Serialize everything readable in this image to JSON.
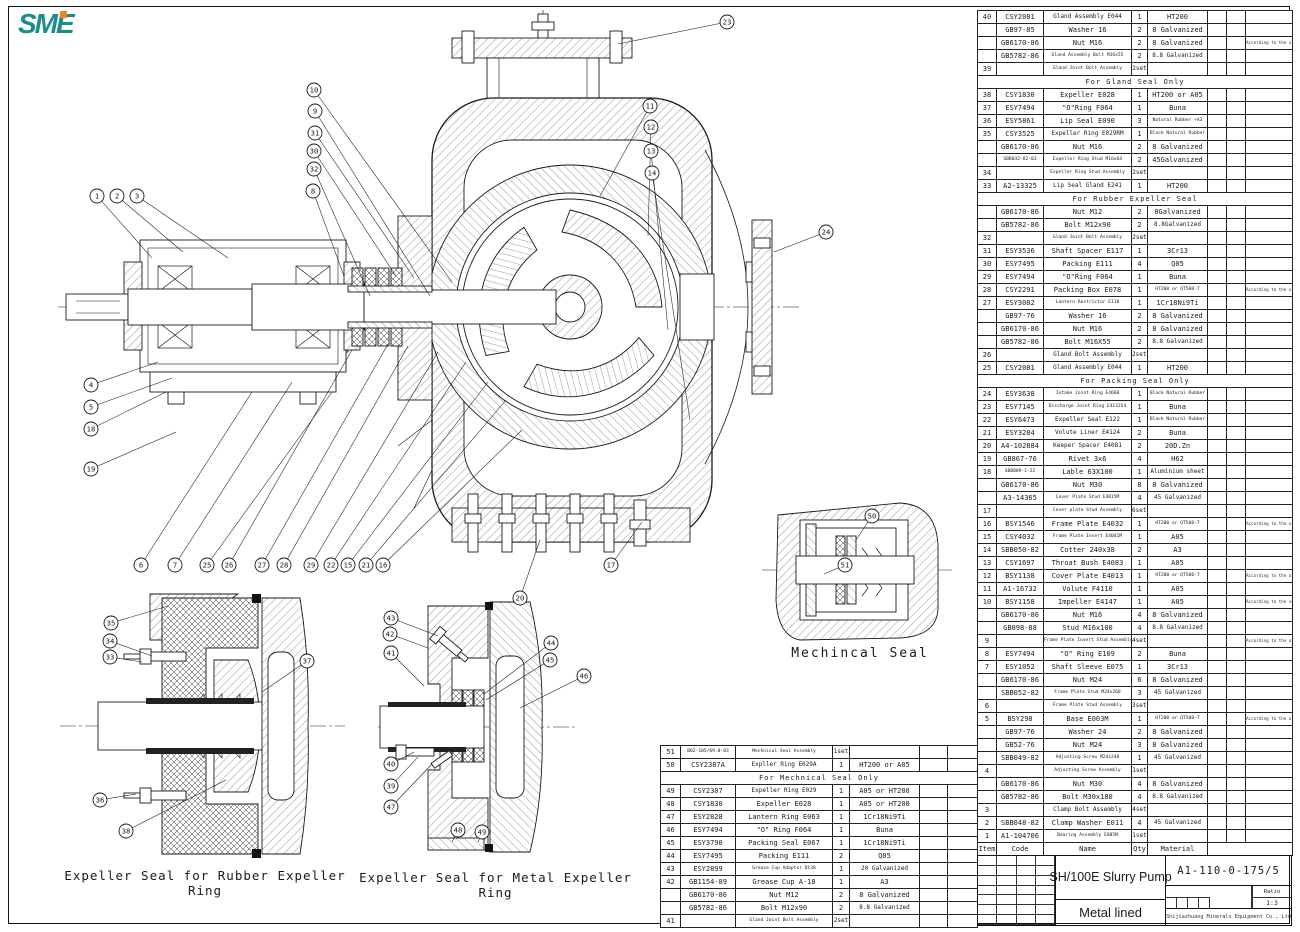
{
  "logo": {
    "text": "SME",
    "teal": "#1b8d8d",
    "orange": "#f0861e"
  },
  "labels": {
    "mechanical_seal": "Mechincal Seal",
    "rubber_detail": "Expeller Seal for Rubber Expeller Ring",
    "metal_detail": "Expeller Seal for Metal Expeller Ring"
  },
  "title_block": {
    "drawing_number": "A1-110-0-175/5",
    "title": "SH/100E Slurry Pump",
    "lining": "Metal lined",
    "ratio_label": "Ratio",
    "ratio_value": "1:3",
    "company": "Shijiazhuang Minerals Equipment Co., Ltd"
  },
  "parts_table": {
    "headers": {
      "item": "Item",
      "code": "Code",
      "name": "Name",
      "qty": "Qty",
      "material": "Material"
    },
    "rows": [
      {
        "item": "40",
        "code": "CSY2081",
        "name": "Gland Assembly E044",
        "qty": "1",
        "mat": "HT200"
      },
      {
        "code": "GB97-85",
        "name": "Washer 16",
        "qty": "2",
        "mat": "8 Galvanized"
      },
      {
        "code": "GB6170-86",
        "name": "Nut  M16",
        "qty": "2",
        "mat": "8 Galvanized",
        "remark": "According to the order"
      },
      {
        "code": "GB5782-86",
        "name": "Gland Assembly Bolt M16x55",
        "qty": "2",
        "mat": "8.8 Galvanized"
      },
      {
        "item": "39",
        "name": "Gland Joint Bolt Assembly",
        "qty": "2set"
      },
      {
        "section": "For Gland Seal Only"
      },
      {
        "item": "38",
        "code": "CSY1830",
        "name": "Expeller  E028",
        "qty": "1",
        "mat": "HT200 or A05"
      },
      {
        "item": "37",
        "code": "ESY7494",
        "name": "\"O\"Ring F064",
        "qty": "1",
        "mat": "Buna"
      },
      {
        "item": "36",
        "code": "ESY5861",
        "name": "Lip Seal E090",
        "qty": "3",
        "mat": "Natural Rubber +A3"
      },
      {
        "item": "35",
        "code": "CSY3525",
        "name": "Expeller Ring E029RM",
        "qty": "1",
        "mat": "Black Natural Rubber"
      },
      {
        "code": "GB6170-86",
        "name": "Nut  M16",
        "qty": "2",
        "mat": "8 Galvanized"
      },
      {
        "code": "SBB032-82-03",
        "name": "Expeller Ring Stud M16x64",
        "qty": "2",
        "mat": "45Galvanized"
      },
      {
        "item": "34",
        "name": "Expeller Ring Stud Assembly",
        "qty": "2set"
      },
      {
        "item": "33",
        "code": "A2-13325",
        "name": "Lip Seal Gland E241",
        "qty": "1",
        "mat": "HT200"
      },
      {
        "section": "For Rubber Expeller Seal"
      },
      {
        "code": "GB6170-86",
        "name": "Nut  M12",
        "qty": "2",
        "mat": "8Galvanized"
      },
      {
        "code": "GB5782-86",
        "name": "Bolt  M12x90",
        "qty": "2",
        "mat": "8.8Galvanized"
      },
      {
        "item": "32",
        "name": "Gland Joint Bolt Assembly",
        "qty": "2set"
      },
      {
        "item": "31",
        "code": "ESY3536",
        "name": "Shaft Spacer E117",
        "qty": "1",
        "mat": "3Cr13"
      },
      {
        "item": "30",
        "code": "ESY7495",
        "name": "Packing E111",
        "qty": "4",
        "mat": "Q05"
      },
      {
        "item": "29",
        "code": "ESY7494",
        "name": "\"O\"Ring F064",
        "qty": "1",
        "mat": "Buna"
      },
      {
        "item": "28",
        "code": "CSY2291",
        "name": "Packing Box E078",
        "qty": "1",
        "mat": "HT200 or QT500-7",
        "remark": "According to the order"
      },
      {
        "item": "27",
        "code": "ESY3082",
        "name": "Lantern Restrictor E118",
        "qty": "1",
        "mat": "1Cr18Ni9Ti"
      },
      {
        "code": "GB97-76",
        "name": "Washer 16",
        "qty": "2",
        "mat": "8 Galvanized"
      },
      {
        "code": "GB6170-86",
        "name": "Nut M16",
        "qty": "2",
        "mat": "8 Galvanized"
      },
      {
        "code": "GB5782-86",
        "name": "Bolt M16X55",
        "qty": "2",
        "mat": "8.8 Galvanized"
      },
      {
        "item": "26",
        "name": "Gland Bolt Assembly",
        "qty": "2sets"
      },
      {
        "item": "25",
        "code": "CSY2081",
        "name": "Gland Assembly E044",
        "qty": "1",
        "mat": "HT200"
      },
      {
        "section": "For Packing Seal Only"
      },
      {
        "item": "24",
        "code": "ESY3638",
        "name": "Intake Joint Ring E4660",
        "qty": "1",
        "mat": "Black Natural Rubber"
      },
      {
        "item": "23",
        "code": "ESY7145",
        "name": "Discharge Joint Ring E4132S4",
        "qty": "1",
        "mat": "Buna"
      },
      {
        "item": "22",
        "code": "ESY6473",
        "name": "Expeller Seal E122",
        "qty": "1",
        "mat": "Black Natural Rubber"
      },
      {
        "item": "21",
        "code": "ESY3284",
        "name": "Volute Liner E4124",
        "qty": "2",
        "mat": "Buna"
      },
      {
        "item": "20",
        "code": "A4-102884",
        "name": "Keeper Spacer E4081",
        "qty": "2",
        "mat": "20D.Zn"
      },
      {
        "item": "19",
        "code": "GB867-76",
        "name": "Rivet 3x6",
        "qty": "4",
        "mat": "H62"
      },
      {
        "item": "18",
        "code": "SBB009-1-22",
        "name": "Lable 63X100",
        "qty": "1",
        "mat": "Aluminium sheet"
      },
      {
        "code": "GB6170-86",
        "name": "Nut  M30",
        "qty": "8",
        "mat": "8 Galvanized"
      },
      {
        "code": "A3-14365",
        "name": "Cover Plate Stud E4015M",
        "qty": "4",
        "mat": "45 Galvanized"
      },
      {
        "item": "17",
        "name": "Cover plate Stud Assembly",
        "qty": "6sets"
      },
      {
        "item": "16",
        "code": "BSY1546",
        "name": "Frame Plate E4032",
        "qty": "1",
        "mat": "HT200 or QT500-7",
        "remark": "According to the order"
      },
      {
        "item": "15",
        "code": "CSY4032",
        "name": "Frame Plate Insert E4041M",
        "qty": "1",
        "mat": "A05"
      },
      {
        "item": "14",
        "code": "SBB050-82",
        "name": "Cotter 240x38",
        "qty": "2",
        "mat": "A3"
      },
      {
        "item": "13",
        "code": "CSY1697",
        "name": "Throat Bush E4083",
        "qty": "1",
        "mat": "A05"
      },
      {
        "item": "12",
        "code": "BSY1138",
        "name": "Cover Plate E4013",
        "qty": "1",
        "mat": "HT200 or QT500-7",
        "remark": "According to the order"
      },
      {
        "item": "11",
        "code": "A1-16732",
        "name": "Volute F4110",
        "qty": "1",
        "mat": "A05"
      },
      {
        "item": "10",
        "code": "BSY1158",
        "name": "Impeller E4147",
        "qty": "1",
        "mat": "A05",
        "remark": "According to the seal type"
      },
      {
        "code": "GB6170-86",
        "name": "Nut M16",
        "qty": "4",
        "mat": "8 Galvanized"
      },
      {
        "code": "GB898-88",
        "name": "Stud M16x100",
        "qty": "4",
        "mat": "8.8 Galvanized"
      },
      {
        "item": "9",
        "name": "Frame Plate Insert Stud Assembly",
        "qty": "4sets",
        "remark": "According to the order"
      },
      {
        "item": "8",
        "code": "ESY7494",
        "name": "\"O\" Ring E109",
        "qty": "2",
        "mat": "Buna"
      },
      {
        "item": "7",
        "code": "ESY1052",
        "name": "Shaft Sleeve E075",
        "qty": "1",
        "mat": "3Cr13"
      },
      {
        "code": "GB6170-86",
        "name": "Nut M24",
        "qty": "6",
        "mat": "8 Galvanized"
      },
      {
        "code": "SBB052-82",
        "name": "Frame Plate Stud M24x260",
        "qty": "3",
        "mat": "45 Galvanized"
      },
      {
        "item": "6",
        "name": "Frame Plate Stud Assembly",
        "qty": "3sets"
      },
      {
        "item": "5",
        "code": "BSY298",
        "name": "Base E003M",
        "qty": "1",
        "mat": "HT200 or QT500-7",
        "remark": "According to the order"
      },
      {
        "code": "GB97-76",
        "name": "Washer 24",
        "qty": "2",
        "mat": "8 Galvanized"
      },
      {
        "code": "GB52-76",
        "name": "Nut M24",
        "qty": "3",
        "mat": "8 Galvanized"
      },
      {
        "code": "SBB049-82",
        "name": "Adjusting Screw M24x240",
        "qty": "1",
        "mat": "45 Galvanized"
      },
      {
        "item": "4",
        "name": "Adjusting Screw Assembly",
        "qty": "1set"
      },
      {
        "code": "GB6170-86",
        "name": "Nut M30",
        "qty": "4",
        "mat": "8 Galvanized"
      },
      {
        "code": "GB5782-86",
        "name": "Bolt  M30x180",
        "qty": "4",
        "mat": "8.8 Galvanized"
      },
      {
        "item": "3",
        "name": "Clamp Bolt Assembly",
        "qty": "4set"
      },
      {
        "item": "2",
        "code": "SBB048-82",
        "name": "Clamp Washer E011",
        "qty": "4",
        "mat": "45 Galvanized"
      },
      {
        "item": "1",
        "code": "A1-104706",
        "name": "Bearing Assembly E085M",
        "qty": "1set"
      },
      {
        "header": true
      }
    ]
  },
  "seal_table": {
    "rows": [
      {
        "item": "51",
        "code": "B02-105/69.0-03",
        "name": "Mechnical Seal Assembly",
        "qty": "1set"
      },
      {
        "item": "50",
        "code": "CSY2387A",
        "name": "Expller Ring E029A",
        "qty": "1",
        "mat": "HT200 or A05"
      },
      {
        "section": "For Mechnical Seal Only"
      },
      {
        "item": "49",
        "code": "CSY2307",
        "name": "Expeller Ring E029",
        "qty": "1",
        "mat": "A05 or HT200"
      },
      {
        "item": "48",
        "code": "CSY1830",
        "name": "Expeller E028",
        "qty": "1",
        "mat": "A05 or HT200"
      },
      {
        "item": "47",
        "code": "ESY2828",
        "name": "Lantern Ring E063",
        "qty": "1",
        "mat": "1Cr18Ni9Ti"
      },
      {
        "item": "46",
        "code": "ESY7494",
        "name": "\"O\" Ring F064",
        "qty": "1",
        "mat": "Buna"
      },
      {
        "item": "45",
        "code": "ESY3790",
        "name": "Packing Seal E067",
        "qty": "1",
        "mat": "1Cr18Ni9Ti"
      },
      {
        "item": "44",
        "code": "ESY7495",
        "name": "Packing E111",
        "qty": "2",
        "mat": "Q05"
      },
      {
        "item": "43",
        "code": "ESY2899",
        "name": "Grease Cup Adaptor Dt38",
        "qty": "1",
        "mat": "20 Galvanized"
      },
      {
        "item": "42",
        "code": "GB1154-89",
        "name": "Grease Cup A-18",
        "qty": "1",
        "mat": "A3"
      },
      {
        "code": "GB6170-86",
        "name": "Nut M12",
        "qty": "2",
        "mat": "8 Galvanized"
      },
      {
        "code": "GB5782-86",
        "name": "Bolt  M12x90",
        "qty": "2",
        "mat": "8.8 Galvanized"
      },
      {
        "item": "41",
        "name": "Gland Joint Bolt Assembly",
        "qty": "2set"
      }
    ]
  },
  "callouts": {
    "main": [
      {
        "n": "1",
        "x": 97,
        "y": 196,
        "tx": 152,
        "ty": 258
      },
      {
        "n": "2",
        "x": 117,
        "y": 196,
        "tx": 183,
        "ty": 252
      },
      {
        "n": "3",
        "x": 137,
        "y": 196,
        "tx": 228,
        "ty": 258
      },
      {
        "n": "10",
        "x": 314,
        "y": 90,
        "tx": 452,
        "ty": 282
      },
      {
        "n": "9",
        "x": 315,
        "y": 111,
        "tx": 430,
        "ty": 296
      },
      {
        "n": "31",
        "x": 315,
        "y": 133,
        "tx": 414,
        "ty": 278
      },
      {
        "n": "30",
        "x": 314,
        "y": 151,
        "tx": 396,
        "ty": 276
      },
      {
        "n": "32",
        "x": 314,
        "y": 169,
        "tx": 370,
        "ty": 296
      },
      {
        "n": "8",
        "x": 313,
        "y": 191,
        "tx": 344,
        "ty": 276
      },
      {
        "n": "23",
        "x": 727,
        "y": 22,
        "tx": 618,
        "ty": 44
      },
      {
        "n": "11",
        "x": 650,
        "y": 106,
        "tx": 600,
        "ty": 196
      },
      {
        "n": "12",
        "x": 651,
        "y": 127,
        "tx": 648,
        "ty": 236
      },
      {
        "n": "13",
        "x": 651,
        "y": 151,
        "tx": 668,
        "ty": 330
      },
      {
        "n": "14",
        "x": 652,
        "y": 173,
        "tx": 690,
        "ty": 420
      },
      {
        "n": "24",
        "x": 826,
        "y": 232,
        "tx": 774,
        "ty": 252
      },
      {
        "n": "4",
        "x": 91,
        "y": 385,
        "tx": 158,
        "ty": 362
      },
      {
        "n": "5",
        "x": 91,
        "y": 407,
        "tx": 172,
        "ty": 378
      },
      {
        "n": "18",
        "x": 91,
        "y": 429,
        "tx": 166,
        "ty": 392
      },
      {
        "n": "19",
        "x": 91,
        "y": 469,
        "tx": 176,
        "ty": 432
      },
      {
        "n": "6",
        "x": 141,
        "y": 565,
        "tx": 252,
        "ty": 392
      },
      {
        "n": "7",
        "x": 175,
        "y": 565,
        "tx": 292,
        "ty": 382
      },
      {
        "n": "25",
        "x": 207,
        "y": 565,
        "tx": 332,
        "ty": 392
      },
      {
        "n": "26",
        "x": 229,
        "y": 565,
        "tx": 352,
        "ty": 350
      },
      {
        "n": "27",
        "x": 262,
        "y": 565,
        "tx": 388,
        "ty": 344
      },
      {
        "n": "28",
        "x": 284,
        "y": 565,
        "tx": 408,
        "ty": 346
      },
      {
        "n": "29",
        "x": 311,
        "y": 565,
        "tx": 438,
        "ty": 352
      },
      {
        "n": "22",
        "x": 331,
        "y": 565,
        "tx": 466,
        "ty": 362
      },
      {
        "n": "15",
        "x": 348,
        "y": 565,
        "tx": 488,
        "ty": 382
      },
      {
        "n": "21",
        "x": 366,
        "y": 565,
        "tx": 506,
        "ty": 400
      },
      {
        "n": "16",
        "x": 383,
        "y": 565,
        "tx": 522,
        "ty": 430
      },
      {
        "n": "20",
        "x": 520,
        "y": 598,
        "tx": 540,
        "ty": 540
      },
      {
        "n": "17",
        "x": 611,
        "y": 565,
        "tx": 642,
        "ty": 522
      }
    ],
    "mech_seal": [
      {
        "n": "50",
        "x": 872,
        "y": 516,
        "tx": 856,
        "ty": 540
      },
      {
        "n": "51",
        "x": 845,
        "y": 565,
        "tx": 824,
        "ty": 574
      }
    ],
    "rubber_detail": [
      {
        "n": "35",
        "x": 111,
        "y": 623,
        "tx": 168,
        "ty": 606
      },
      {
        "n": "34",
        "x": 110,
        "y": 641,
        "tx": 152,
        "ty": 656
      },
      {
        "n": "33",
        "x": 110,
        "y": 657,
        "tx": 142,
        "ty": 662
      },
      {
        "n": "37",
        "x": 307,
        "y": 661,
        "tx": 262,
        "ty": 692
      },
      {
        "n": "36",
        "x": 100,
        "y": 800,
        "tx": 136,
        "ty": 794
      },
      {
        "n": "38",
        "x": 126,
        "y": 831,
        "tx": 226,
        "ty": 780
      }
    ],
    "metal_detail": [
      {
        "n": "43",
        "x": 391,
        "y": 618,
        "tx": 438,
        "ty": 636
      },
      {
        "n": "42",
        "x": 390,
        "y": 634,
        "tx": 428,
        "ty": 648
      },
      {
        "n": "41",
        "x": 391,
        "y": 653,
        "tx": 424,
        "ty": 686
      },
      {
        "n": "44",
        "x": 551,
        "y": 643,
        "tx": 484,
        "ty": 694
      },
      {
        "n": "45",
        "x": 550,
        "y": 660,
        "tx": 486,
        "ty": 700
      },
      {
        "n": "46",
        "x": 584,
        "y": 676,
        "tx": 520,
        "ty": 708
      },
      {
        "n": "40",
        "x": 391,
        "y": 764,
        "tx": 414,
        "ty": 752
      },
      {
        "n": "39",
        "x": 391,
        "y": 786,
        "tx": 418,
        "ty": 757
      },
      {
        "n": "47",
        "x": 391,
        "y": 807,
        "tx": 432,
        "ty": 764
      },
      {
        "n": "48",
        "x": 458,
        "y": 830,
        "tx": 452,
        "ty": 842
      },
      {
        "n": "49",
        "x": 482,
        "y": 832,
        "tx": 478,
        "ty": 842
      }
    ]
  }
}
